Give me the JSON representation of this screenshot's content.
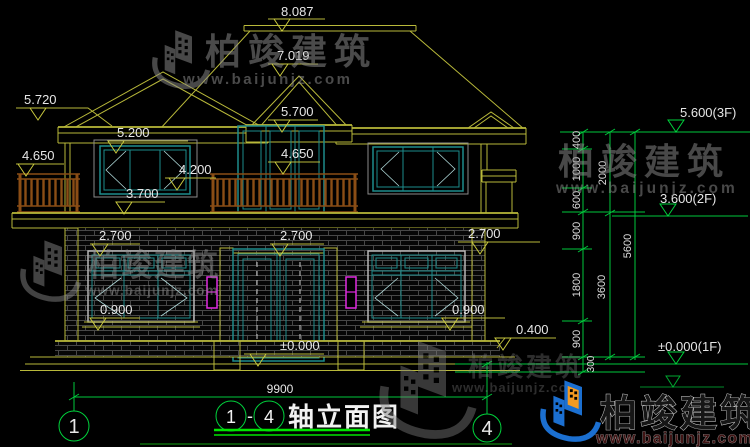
{
  "drawing_title": {
    "axis_start": "1",
    "separator": "-",
    "axis_end": "4",
    "name": "轴立面图"
  },
  "axis_bubbles": {
    "left": "1",
    "right": "4"
  },
  "watermark": {
    "brand": "柏竣建筑",
    "url": "www.baijunjz.com"
  },
  "overall_width": "9900",
  "elevation_marks": {
    "ridge": "8.087",
    "upper_ridge": "7.019",
    "left_eave": "5.720",
    "left_window_head": "5.200",
    "center_eave": "5.700",
    "left_rail": "4.650",
    "center_rail": "4.650",
    "left_window_sill": "4.200",
    "balcony_floor": "3.700",
    "f1_head_left": "2.700",
    "f1_head_center": "2.700",
    "f1_head_right": "2.700",
    "f1_sill_left": "0.900",
    "f1_sill_right": "0.900",
    "ground": "±0.000",
    "plinth": "0.400"
  },
  "right_dim_chain": {
    "segments": [
      "400",
      "1000",
      "600",
      "900",
      "1800",
      "900",
      "300"
    ],
    "subtotals": [
      "2000",
      "3600"
    ],
    "total": "5600",
    "levels": {
      "third": "5.600(3F)",
      "second": "3.600(2F)",
      "first": "±0.000(1F)"
    }
  },
  "colors": {
    "cad_line": "#b9b93a",
    "axis_green": "#00d23c",
    "window_frame": "#1d8c8c",
    "railing": "#8a4d15",
    "lamp": "#e02ce0",
    "dim_text": "#e6e6e6"
  }
}
